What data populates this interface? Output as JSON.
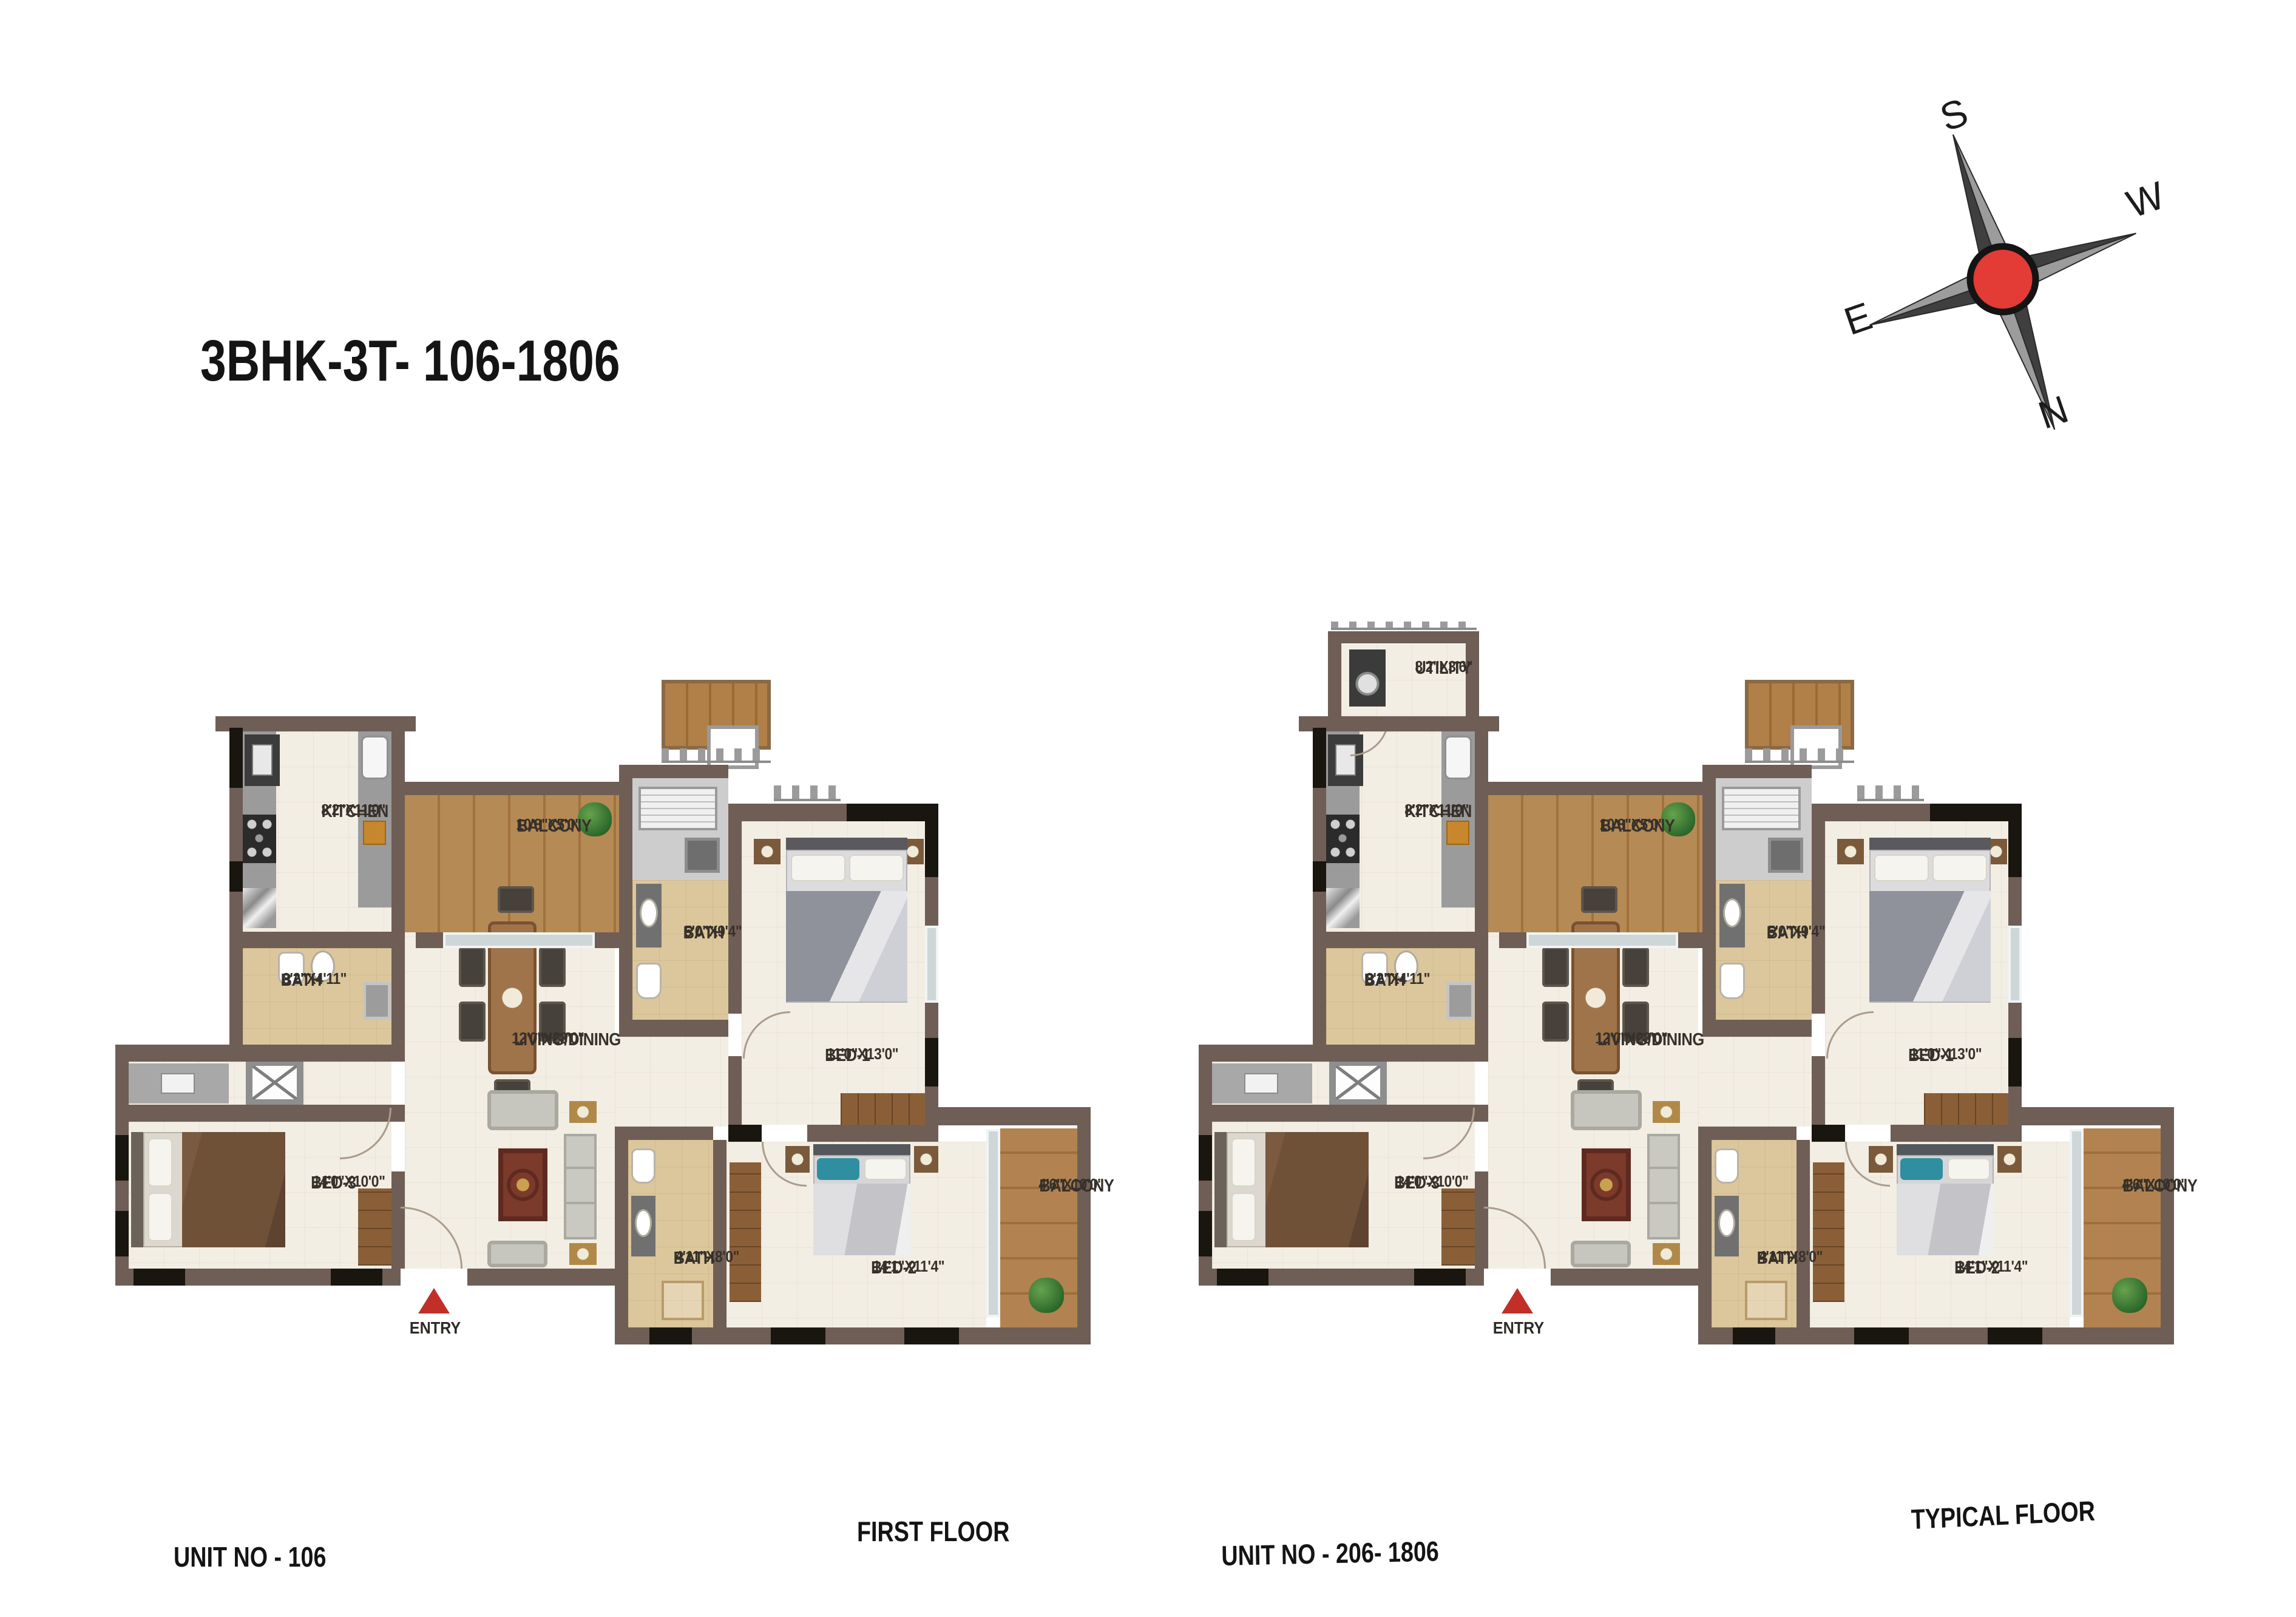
{
  "title": "3BHK-3T- 106-1806",
  "compass": {
    "top": "S",
    "right": "W",
    "left": "E",
    "bottom": "N"
  },
  "floor_captions": {
    "left": "FIRST FLOOR",
    "right": "TYPICAL FLOOR"
  },
  "colors": {
    "wall": "#6f5e56",
    "window": "#19150f",
    "floor_cream": "#f3eee4",
    "bath_tan": "#dcc79c",
    "balcony_wood": "#b68a55",
    "entry_red": "#c03028",
    "compass_red": "#e33b35"
  },
  "plans": [
    {
      "caption": "UNIT NO - 106",
      "entry_label": "ENTRY",
      "rooms": {
        "kitchen": {
          "name": "KITCHEN",
          "dims": "8'2\"X11'0\""
        },
        "balcony_top": {
          "name": "BALCONY",
          "dims": "10'8\"X5'0\""
        },
        "bath_top": {
          "name": "BATH",
          "dims": "5'0\"X9'4\""
        },
        "bed1": {
          "name": "BED-1",
          "dims": "11'0\"X13'0\""
        },
        "bath_left": {
          "name": "BATH",
          "dims": "8'2\"X4'11\""
        },
        "living": {
          "name": "LIVING/DINING",
          "dims": "12'0\"X23'0\""
        },
        "bed3": {
          "name": "BED-3",
          "dims": "14'0\"X10'0\""
        },
        "bath_mid": {
          "name": "BATH",
          "dims": "4'11\"X8'0\""
        },
        "bed2": {
          "name": "BED-2",
          "dims": "14'1\"X11'4\""
        },
        "balcony_right": {
          "name": "BALCONY",
          "dims": "4'6\"X10'0\""
        }
      }
    },
    {
      "caption": "UNIT NO - 206- 1806",
      "entry_label": "ENTRY",
      "rooms": {
        "utility": {
          "name": "UTILITY",
          "dims": "8'2\"X3'6\""
        },
        "kitchen": {
          "name": "KITCHEN",
          "dims": "8'2\"X11'0\""
        },
        "balcony_top": {
          "name": "BALCONY",
          "dims": "10'8\"X5'0\""
        },
        "bath_top": {
          "name": "BATH",
          "dims": "5'0\"X9'4\""
        },
        "bed1": {
          "name": "BED-1",
          "dims": "11'0\"X13'0\""
        },
        "bath_left": {
          "name": "BATH",
          "dims": "8'2\"X4'11\""
        },
        "living": {
          "name": "LIVING/DINING",
          "dims": "12'0\"X23'0\""
        },
        "bed3": {
          "name": "BED-3",
          "dims": "14'0\"X10'0\""
        },
        "bath_mid": {
          "name": "BATH",
          "dims": "4'11\"X8'0\""
        },
        "bed2": {
          "name": "BED-2",
          "dims": "14'1\"X11'4\""
        },
        "balcony_right": {
          "name": "BALCONY",
          "dims": "4'6\"X10'0\""
        }
      }
    }
  ]
}
